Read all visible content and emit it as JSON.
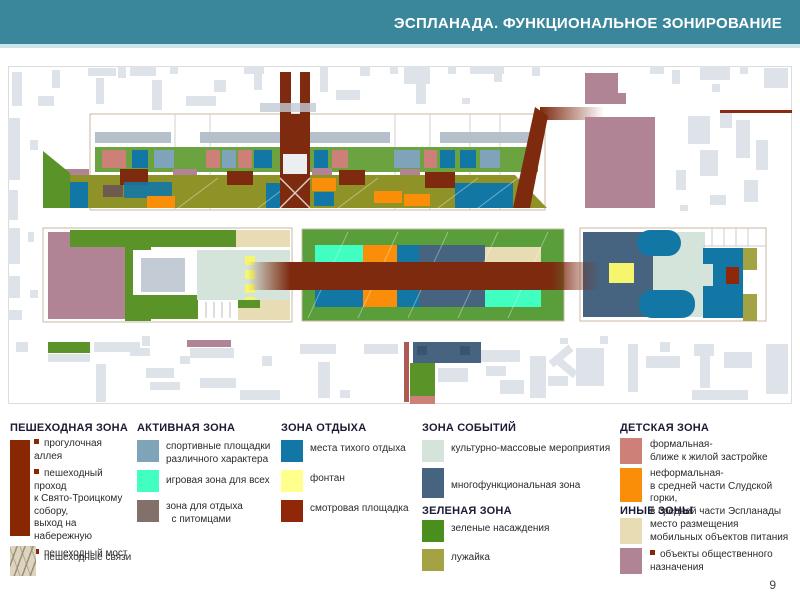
{
  "header": {
    "title": "ЭСПЛАНАДА. ФУНКЦИОНАЛЬНОЕ ЗОНИРОВАНИЕ"
  },
  "page_number": "9",
  "palette": {
    "header_teal": "#3a879b",
    "walkway_maroon": "#8a2703",
    "corridor_dark_red": "#7d2a0f",
    "sport_steel_blue": "#7fa3b8",
    "play_mint": "#40ffc0",
    "pets_taupe": "#84706b",
    "quiet_rest_blue": "#1377a5",
    "fountain_yellow": "#ffff8c",
    "viewpoint_red": "#8f2708",
    "events_pale_green": "#d4e4da",
    "multifunction_slate": "#46637f",
    "greenery_green": "#4a8f1e",
    "lawn_olive": "#a3a344",
    "kids_formal_salmon": "#cc8077",
    "kids_informal_orange": "#fb8e09",
    "food_beige": "#e8dcb5",
    "public_rose": "#b08495",
    "building_gray": "#dde3e9"
  },
  "legend": {
    "pedestrian": {
      "title": "ПЕШЕХОДНАЯ ЗОНА",
      "items": [
        "прогулочная аллея",
        "пешеходный\nпроход\nк Свято-Троицкому\nсобору,\nвыход на\nнабережную",
        "пешеходный мост"
      ],
      "links_label": "пешеходные связи"
    },
    "active": {
      "title": "АКТИВНАЯ ЗОНА",
      "items": [
        {
          "label": "спортивные площадки\nразличного характера",
          "color": "#7fa3b8"
        },
        {
          "label": "игровая зона для всех",
          "color": "#40ffc0"
        },
        {
          "label": "зона для отдыха\n  с питомцами",
          "color": "#84706b"
        }
      ]
    },
    "rest": {
      "title": "ЗОНА ОТДЫХА",
      "items": [
        {
          "label": "места тихого отдыха",
          "color": "#1377a5"
        },
        {
          "label": "фонтан",
          "color": "#ffff8c"
        },
        {
          "label": "смотровая площадка",
          "color": "#8f2708"
        }
      ]
    },
    "events": {
      "title": "ЗОНА СОБЫТИЙ",
      "items": [
        {
          "label": "культурно-массовые мероприятия",
          "color": "#d4e4da"
        },
        {
          "label": "многофункциональная зона",
          "color": "#46637f"
        }
      ]
    },
    "green": {
      "title": "ЗЕЛЕНАЯ ЗОНА",
      "items": [
        {
          "label": "зеленые насаждения",
          "color": "#4a8f1e"
        },
        {
          "label": "лужайка",
          "color": "#a3a344"
        }
      ]
    },
    "kids": {
      "title": "ДЕТСКАЯ ЗОНА",
      "items": [
        {
          "label": "формальная-\nближе к жилой застройке",
          "color": "#cc8077"
        },
        {
          "label": "неформальная-\nв средней части Слудской горки,\nв средней части Эспланады",
          "color": "#fb8e09"
        }
      ]
    },
    "other": {
      "title": "ИНЫЕ ЗОНЫ",
      "items": [
        {
          "label": "место размещения\nмобильных объектов питания",
          "color": "#e8dcb5"
        },
        {
          "label": "объекты общественного\nназначения",
          "color": "#b08495"
        }
      ]
    }
  }
}
